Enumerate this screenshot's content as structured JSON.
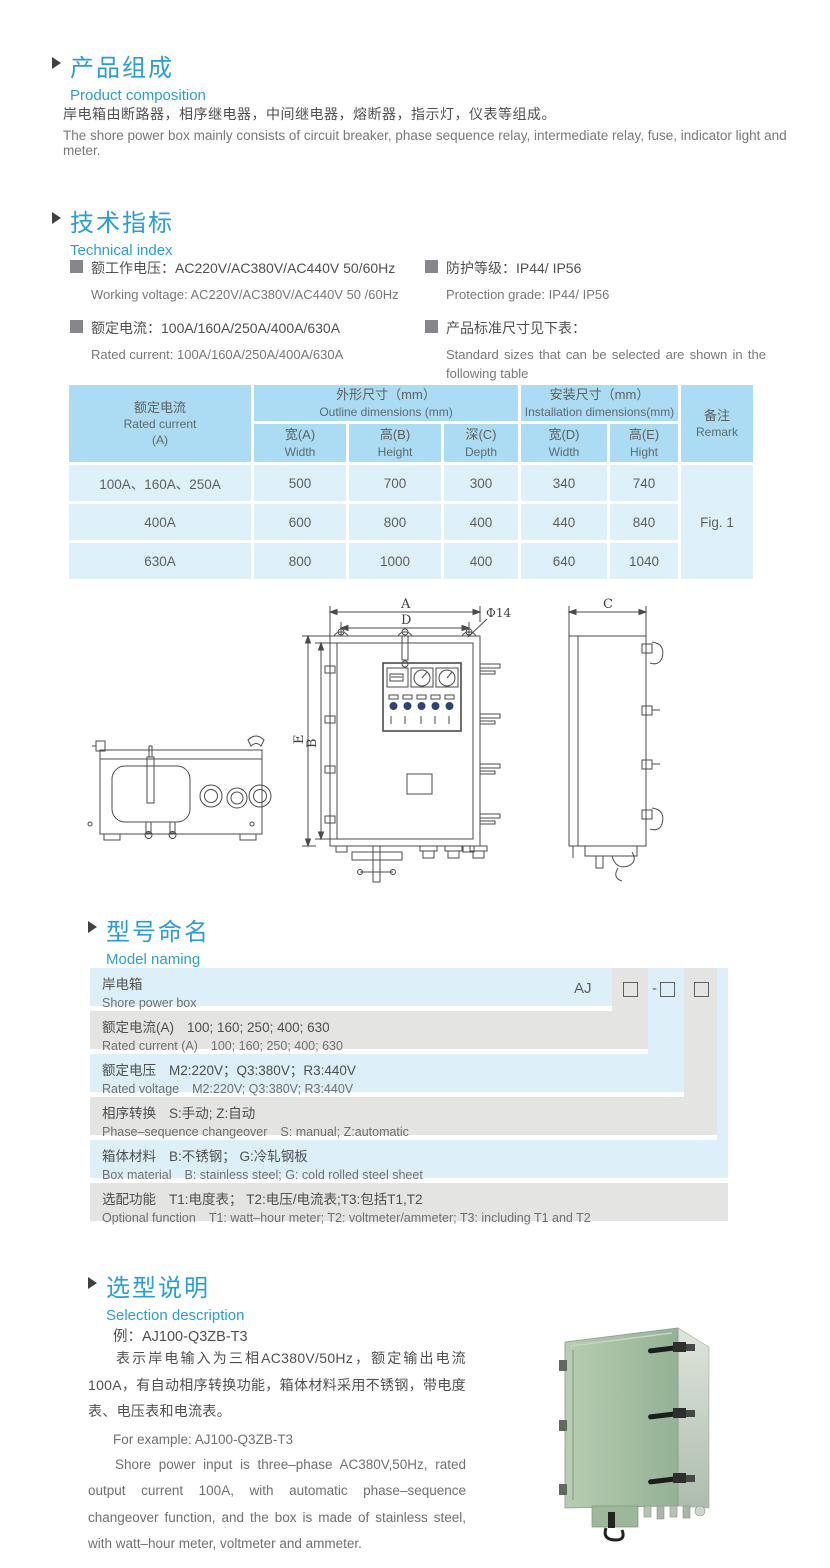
{
  "colors": {
    "accent_blue": "#2b9ed8",
    "table_header_bg": "#abdcf3",
    "table_cell_bg": "#def1fb",
    "band_blue": "#ddf0fa",
    "band_grey": "#e4e4e2",
    "product_green": "#a3c2a4"
  },
  "product_composition": {
    "title_cn": "产品组成",
    "title_en": "Product  composition",
    "body_cn": "岸电箱由断路器，相序继电器，中间继电器，熔断器，指示灯，仪表等组成。",
    "body_en": "The shore power box mainly consists of circuit breaker, phase sequence relay, intermediate relay, fuse, indicator light and meter."
  },
  "technical_index": {
    "title_cn": "技术指标",
    "title_en": "Technical index",
    "specs": [
      {
        "cn": "额工作电压：AC220V/AC380V/AC440V  50/60Hz",
        "en": "Working voltage: AC220V/AC380V/AC440V 50 /60Hz"
      },
      {
        "cn": "额定电流：100A/160A/250A/400A/630A",
        "en": "Rated current: 100A/160A/250A/400A/630A"
      },
      {
        "cn": "防护等级：IP44/ IP56",
        "en": "Protection grade: IP44/ IP56"
      },
      {
        "cn": "产品标准尺寸见下表：",
        "en": "Standard sizes that can be selected are shown in the following table"
      }
    ]
  },
  "size_table": {
    "header": {
      "current_cn": "额定电流",
      "current_en": "Rated current",
      "current_unit": "(A)",
      "outline_cn": "外形尺寸（mm）",
      "outline_en": "Outline dimensions (mm)",
      "install_cn": "安装尺寸（mm）",
      "install_en": "Installation dimensions(mm)",
      "remark_cn": "备注",
      "remark_en": "Remark",
      "sub": [
        {
          "cn": "宽(A)",
          "en": "Width"
        },
        {
          "cn": "高(B)",
          "en": "Height"
        },
        {
          "cn": "深(C)",
          "en": "Depth"
        },
        {
          "cn": "宽(D)",
          "en": "Width"
        },
        {
          "cn": "高(E)",
          "en": "Hight"
        }
      ]
    },
    "rows": [
      {
        "current": "100A、160A、250A",
        "w": "500",
        "h": "700",
        "d": "300",
        "iw": "340",
        "ih": "740"
      },
      {
        "current": "400A",
        "w": "600",
        "h": "800",
        "d": "400",
        "iw": "440",
        "ih": "840"
      },
      {
        "current": "630A",
        "w": "800",
        "h": "1000",
        "d": "400",
        "iw": "640",
        "ih": "1040"
      }
    ],
    "remark_value": "Fig. 1"
  },
  "drawing": {
    "dim_a": "A",
    "dim_d": "D",
    "hole": "Φ14",
    "dim_e": "E",
    "dim_b": "B",
    "dim_c": "C"
  },
  "model_naming": {
    "title_cn": "型号命名",
    "title_en": "Model naming",
    "code_prefix": "AJ",
    "code_dash": "-",
    "rows": [
      {
        "label_cn": "岸电箱",
        "label_en": "Shore power box",
        "values_cn": "",
        "values_en": ""
      },
      {
        "label_cn": "额定电流(A)",
        "label_en": "Rated current (A)",
        "values_cn": "100; 160; 250; 400; 630",
        "values_en": "100; 160; 250; 400; 630"
      },
      {
        "label_cn": "额定电压",
        "label_en": "Rated voltage",
        "values_cn": "M2:220V；Q3:380V；R3:440V",
        "values_en": "M2:220V;  Q3:380V;  R3:440V"
      },
      {
        "label_cn": "相序转换",
        "label_en": "Phase–sequence changeover",
        "values_cn": "S:手动; Z:自动",
        "values_en": "S: manual;  Z:automatic"
      },
      {
        "label_cn": "箱体材料",
        "label_en": "Box material",
        "values_cn": "B:不锈钢；  G:冷轧钢板",
        "values_en": "B: stainless steel; G: cold rolled steel sheet"
      },
      {
        "label_cn": "选配功能",
        "label_en": "Optional function",
        "values_cn": "T1:电度表；  T2:电压/电流表;T3:包括T1,T2",
        "values_en": "T1: watt–hour meter; T2: voltmeter/ammeter; T3: including T1 and T2"
      }
    ]
  },
  "selection_description": {
    "title_cn": "选型说明",
    "title_en": "Selection description",
    "example_cn": "例：AJ100-Q3ZB-T3",
    "body_cn": "表示岸电输入为三相AC380V/50Hz，额定输出电流100A，有自动相序转换功能，箱体材料采用不锈钢，带电度表、电压表和电流表。",
    "example_en": "For example: AJ100-Q3ZB-T3",
    "body_en": "Shore power input is three–phase AC380V,50Hz, rated output current 100A, with automatic phase–sequence changeover function, and the box is made of stainless steel, with watt–hour meter, voltmeter and ammeter."
  }
}
